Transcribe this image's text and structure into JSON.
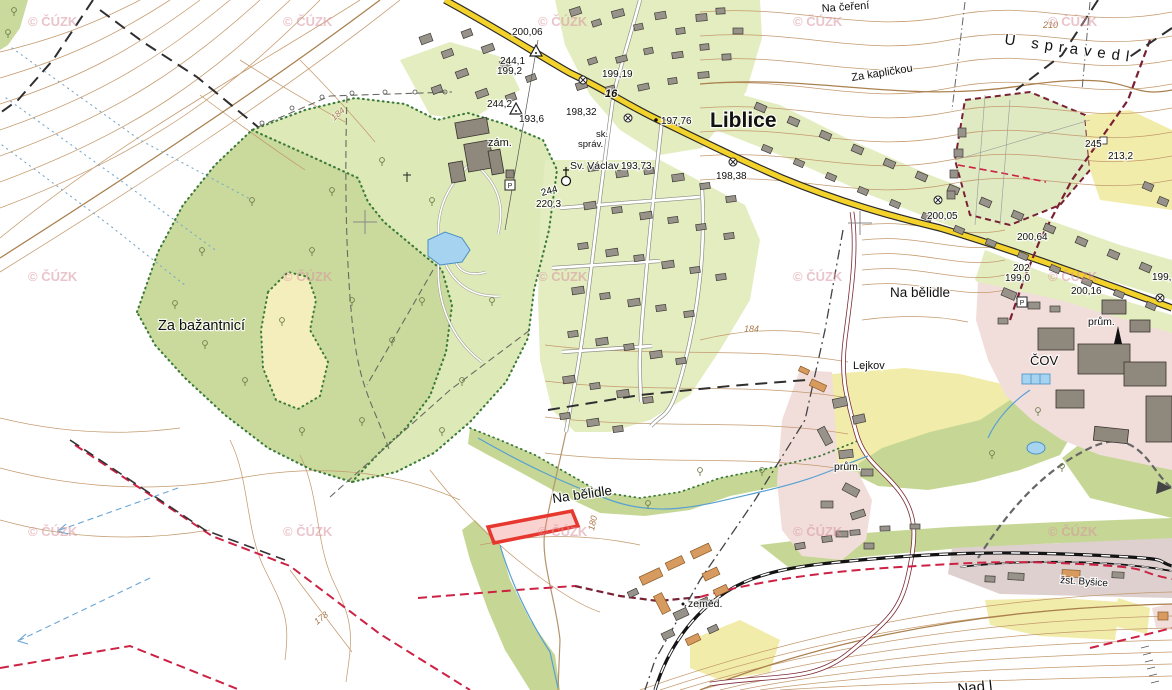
{
  "map": {
    "attribution": {
      "text": "© ČÚZK",
      "positions": [
        [
          28,
          26
        ],
        [
          283,
          26
        ],
        [
          538,
          26
        ],
        [
          793,
          26
        ],
        [
          1048,
          26
        ],
        [
          28,
          281
        ],
        [
          283,
          281
        ],
        [
          538,
          281
        ],
        [
          793,
          281
        ],
        [
          1048,
          281
        ],
        [
          28,
          536
        ],
        [
          283,
          536
        ],
        [
          538,
          536
        ],
        [
          793,
          536
        ],
        [
          1048,
          536
        ]
      ]
    },
    "labels": {
      "liblice": "Liblice",
      "za_bazantnici": "Za bažantnicí",
      "na_belidle_top": "Na bělidle",
      "na_belidle_bottom": "Na bělidle",
      "na_cereni": "Na čeření",
      "za_kaplickou": "Za kapličkou",
      "u_spravedl": "U spravedl",
      "lejkov": "Lejkov",
      "cov": "ČOV",
      "prum_right": "prům.",
      "prum_left": "prům.",
      "zemed": "zeměd.",
      "zst_bysice": "žst. Byšice",
      "zam": "zám.",
      "sk": "sk.",
      "sprav": "správ.",
      "sv_vaclav": "Sv. Václav",
      "nad_partial": "Nad l"
    },
    "road_number": "16",
    "elevations": {
      "e20006": "200,06",
      "e2441": "244,1",
      "e1992": "199,2",
      "e2442": "244,2",
      "e1936": "193,6",
      "e19919": "199,19",
      "e19832": "198,32",
      "e19776": "197,76",
      "e19373": "193,73",
      "e19838": "198,38",
      "e244": "244",
      "e2203": "220,3",
      "e20005": "200,05",
      "e20064": "200,64",
      "e202": "202",
      "e1990": "199,0",
      "e20016": "200,16",
      "e199": "199,",
      "e2132": "213,2",
      "e245": "245"
    },
    "contour_labels": {
      "c210": "210",
      "c184a": "184",
      "c184b": "184",
      "c180": "180",
      "c178": "178"
    },
    "symbols": {
      "parking": "P"
    },
    "colors": {
      "forest": "#c9da9c",
      "park": "#dde9b6",
      "village": "#e3edc0",
      "clearing": "#f4eebc",
      "industrial": "#f1dedb",
      "field_yellow": "#f2ecaa",
      "water": "#a6d3f0",
      "road_yellow": "#f3d32b",
      "contour": "#c49a6e",
      "boundary_red": "#cc2244",
      "cadastre_maroon": "#7a2035",
      "highlight_red": "#e6382f",
      "watermark_pink": "#d894a0",
      "building_gray": "#97938b",
      "building_orange": "#d79a5f"
    },
    "buildings": [
      [
        570,
        8,
        11,
        7,
        -18,
        "g"
      ],
      [
        592,
        20,
        9,
        6,
        -18,
        "g"
      ],
      [
        612,
        10,
        12,
        7,
        -15,
        "g"
      ],
      [
        634,
        24,
        9,
        6,
        -12,
        "g"
      ],
      [
        655,
        12,
        11,
        7,
        -10,
        "g"
      ],
      [
        676,
        28,
        9,
        6,
        -8,
        "g"
      ],
      [
        696,
        14,
        11,
        7,
        -5,
        "g"
      ],
      [
        700,
        44,
        9,
        6,
        -5,
        "g"
      ],
      [
        672,
        52,
        11,
        6,
        -8,
        "g"
      ],
      [
        644,
        48,
        9,
        6,
        -12,
        "g"
      ],
      [
        616,
        56,
        11,
        6,
        -15,
        "g"
      ],
      [
        588,
        58,
        9,
        6,
        -18,
        "g"
      ],
      [
        576,
        82,
        11,
        7,
        -18,
        "g"
      ],
      [
        606,
        86,
        9,
        6,
        -15,
        "g"
      ],
      [
        638,
        84,
        11,
        6,
        -12,
        "g"
      ],
      [
        668,
        78,
        9,
        6,
        -8,
        "g"
      ],
      [
        698,
        72,
        11,
        6,
        -5,
        "g"
      ],
      [
        722,
        54,
        9,
        6,
        -3,
        "g"
      ],
      [
        733,
        28,
        10,
        6,
        0,
        "g"
      ],
      [
        716,
        8,
        9,
        6,
        -3,
        "g"
      ],
      [
        420,
        35,
        12,
        8,
        -20,
        "g"
      ],
      [
        442,
        50,
        11,
        7,
        -20,
        "g"
      ],
      [
        462,
        30,
        10,
        7,
        -20,
        "g"
      ],
      [
        482,
        45,
        12,
        7,
        -20,
        "g"
      ],
      [
        500,
        60,
        10,
        7,
        -20,
        "g"
      ],
      [
        456,
        70,
        12,
        7,
        -20,
        "g"
      ],
      [
        432,
        86,
        10,
        7,
        -20,
        "g"
      ],
      [
        476,
        90,
        12,
        7,
        -20,
        "g"
      ],
      [
        506,
        94,
        10,
        7,
        -20,
        "g"
      ],
      [
        526,
        75,
        10,
        6,
        -20,
        "g"
      ],
      [
        755,
        104,
        11,
        7,
        23,
        "g"
      ],
      [
        788,
        118,
        11,
        7,
        23,
        "g"
      ],
      [
        820,
        132,
        11,
        7,
        23,
        "g"
      ],
      [
        852,
        146,
        11,
        7,
        23,
        "g"
      ],
      [
        884,
        160,
        11,
        7,
        23,
        "g"
      ],
      [
        916,
        173,
        11,
        7,
        23,
        "g"
      ],
      [
        948,
        186,
        11,
        7,
        23,
        "g"
      ],
      [
        980,
        199,
        11,
        7,
        23,
        "g"
      ],
      [
        1012,
        212,
        11,
        7,
        23,
        "g"
      ],
      [
        1044,
        225,
        11,
        7,
        23,
        "g"
      ],
      [
        1076,
        238,
        11,
        7,
        23,
        "g"
      ],
      [
        1108,
        251,
        11,
        7,
        23,
        "g"
      ],
      [
        1140,
        264,
        11,
        7,
        23,
        "g"
      ],
      [
        762,
        146,
        10,
        6,
        23,
        "g"
      ],
      [
        794,
        160,
        10,
        6,
        23,
        "g"
      ],
      [
        826,
        174,
        10,
        6,
        23,
        "g"
      ],
      [
        858,
        188,
        10,
        6,
        23,
        "g"
      ],
      [
        890,
        201,
        10,
        6,
        23,
        "g"
      ],
      [
        922,
        214,
        10,
        6,
        23,
        "g"
      ],
      [
        954,
        227,
        10,
        6,
        23,
        "g"
      ],
      [
        986,
        240,
        10,
        6,
        23,
        "g"
      ],
      [
        1018,
        253,
        10,
        6,
        23,
        "g"
      ],
      [
        1050,
        266,
        10,
        6,
        23,
        "g"
      ],
      [
        1082,
        279,
        10,
        6,
        23,
        "g"
      ],
      [
        1114,
        291,
        10,
        6,
        23,
        "g"
      ],
      [
        1146,
        303,
        10,
        6,
        23,
        "g"
      ],
      [
        588,
        165,
        10,
        6,
        -8,
        "g"
      ],
      [
        616,
        170,
        12,
        7,
        -8,
        "g"
      ],
      [
        644,
        168,
        10,
        6,
        -8,
        "g"
      ],
      [
        672,
        174,
        12,
        7,
        -8,
        "g"
      ],
      [
        700,
        183,
        10,
        6,
        -8,
        "g"
      ],
      [
        726,
        196,
        10,
        6,
        -8,
        "g"
      ],
      [
        584,
        202,
        12,
        7,
        -8,
        "g"
      ],
      [
        612,
        207,
        10,
        6,
        -8,
        "g"
      ],
      [
        640,
        212,
        12,
        7,
        -8,
        "g"
      ],
      [
        668,
        217,
        10,
        6,
        -8,
        "g"
      ],
      [
        696,
        224,
        10,
        6,
        -8,
        "g"
      ],
      [
        724,
        233,
        10,
        6,
        -8,
        "g"
      ],
      [
        578,
        243,
        10,
        6,
        -8,
        "g"
      ],
      [
        606,
        249,
        12,
        7,
        -8,
        "g"
      ],
      [
        634,
        255,
        10,
        6,
        -8,
        "g"
      ],
      [
        662,
        261,
        12,
        7,
        -8,
        "g"
      ],
      [
        690,
        267,
        10,
        6,
        -8,
        "g"
      ],
      [
        716,
        274,
        10,
        6,
        -8,
        "g"
      ],
      [
        572,
        287,
        12,
        7,
        -8,
        "g"
      ],
      [
        600,
        293,
        10,
        6,
        -8,
        "g"
      ],
      [
        628,
        299,
        12,
        7,
        -8,
        "g"
      ],
      [
        656,
        305,
        10,
        6,
        -8,
        "g"
      ],
      [
        684,
        311,
        10,
        6,
        -8,
        "g"
      ],
      [
        568,
        331,
        10,
        6,
        -8,
        "g"
      ],
      [
        596,
        338,
        12,
        7,
        -8,
        "g"
      ],
      [
        624,
        344,
        10,
        6,
        -8,
        "g"
      ],
      [
        650,
        351,
        12,
        7,
        -8,
        "g"
      ],
      [
        676,
        358,
        10,
        6,
        -8,
        "g"
      ],
      [
        563,
        376,
        12,
        7,
        -8,
        "g"
      ],
      [
        590,
        383,
        10,
        6,
        -8,
        "g"
      ],
      [
        617,
        390,
        12,
        7,
        -8,
        "g"
      ],
      [
        643,
        397,
        10,
        6,
        -8,
        "g"
      ],
      [
        560,
        413,
        10,
        6,
        -8,
        "g"
      ],
      [
        587,
        419,
        12,
        7,
        -8,
        "g"
      ],
      [
        613,
        426,
        10,
        6,
        -8,
        "g"
      ],
      [
        958,
        128,
        8,
        9,
        0,
        "g"
      ],
      [
        954,
        149,
        9,
        8,
        0,
        "g"
      ],
      [
        950,
        170,
        8,
        8,
        0,
        "g"
      ],
      [
        947,
        191,
        8,
        8,
        0,
        "g"
      ],
      [
        1143,
        183,
        10,
        7,
        23,
        "g"
      ],
      [
        1158,
        198,
        10,
        7,
        23,
        "g"
      ],
      [
        1038,
        328,
        36,
        22,
        0,
        "d"
      ],
      [
        1078,
        344,
        52,
        30,
        0,
        "d"
      ],
      [
        1102,
        300,
        24,
        14,
        0,
        "d"
      ],
      [
        1124,
        362,
        42,
        24,
        0,
        "d"
      ],
      [
        1056,
        390,
        28,
        18,
        0,
        "d"
      ],
      [
        1130,
        320,
        20,
        12,
        0,
        "d"
      ],
      [
        1146,
        396,
        26,
        46,
        0,
        "d"
      ],
      [
        1094,
        428,
        34,
        14,
        6,
        "d"
      ],
      [
        1002,
        290,
        14,
        8,
        23,
        "g"
      ],
      [
        1028,
        302,
        12,
        7,
        0,
        "g"
      ],
      [
        1050,
        306,
        10,
        6,
        0,
        "g"
      ],
      [
        998,
        318,
        10,
        6,
        0,
        "g"
      ],
      [
        799,
        368,
        10,
        5,
        25,
        "o"
      ],
      [
        810,
        382,
        16,
        7,
        25,
        "o"
      ],
      [
        833,
        398,
        14,
        9,
        -12,
        "g"
      ],
      [
        853,
        415,
        12,
        8,
        -12,
        "g"
      ],
      [
        816,
        432,
        18,
        8,
        62,
        "g"
      ],
      [
        839,
        450,
        14,
        8,
        -6,
        "g"
      ],
      [
        861,
        469,
        12,
        7,
        0,
        "g"
      ],
      [
        843,
        486,
        16,
        8,
        28,
        "g"
      ],
      [
        821,
        501,
        12,
        7,
        0,
        "g"
      ],
      [
        851,
        511,
        14,
        7,
        -18,
        "g"
      ],
      [
        836,
        531,
        12,
        6,
        0,
        "g"
      ],
      [
        864,
        543,
        10,
        6,
        0,
        "g"
      ],
      [
        640,
        572,
        22,
        9,
        -25,
        "o"
      ],
      [
        666,
        559,
        18,
        8,
        -25,
        "o"
      ],
      [
        691,
        547,
        20,
        8,
        -25,
        "o"
      ],
      [
        703,
        570,
        16,
        8,
        -25,
        "o"
      ],
      [
        652,
        599,
        20,
        9,
        63,
        "o"
      ],
      [
        674,
        610,
        14,
        8,
        -25,
        "g"
      ],
      [
        697,
        599,
        12,
        7,
        -25,
        "g"
      ],
      [
        714,
        587,
        14,
        7,
        -25,
        "o"
      ],
      [
        662,
        631,
        12,
        7,
        -25,
        "g"
      ],
      [
        686,
        636,
        14,
        7,
        -25,
        "o"
      ],
      [
        708,
        626,
        10,
        6,
        -25,
        "g"
      ],
      [
        628,
        590,
        10,
        6,
        -25,
        "g"
      ],
      [
        1008,
        573,
        16,
        7,
        3,
        "g"
      ],
      [
        1062,
        570,
        18,
        7,
        3,
        "o"
      ],
      [
        1112,
        572,
        12,
        6,
        3,
        "g"
      ],
      [
        985,
        576,
        10,
        6,
        3,
        "g"
      ],
      [
        795,
        543,
        10,
        6,
        -10,
        "g"
      ],
      [
        822,
        536,
        10,
        6,
        -8,
        "g"
      ],
      [
        850,
        530,
        10,
        5,
        -4,
        "g"
      ],
      [
        880,
        526,
        10,
        5,
        -2,
        "g"
      ],
      [
        910,
        524,
        10,
        5,
        0,
        "g"
      ],
      [
        1158,
        612,
        10,
        8,
        0,
        "o"
      ],
      [
        456,
        120,
        32,
        16,
        -10,
        "d"
      ],
      [
        466,
        142,
        26,
        28,
        -10,
        "d"
      ],
      [
        450,
        162,
        14,
        20,
        -10,
        "d"
      ],
      [
        490,
        150,
        12,
        24,
        -10,
        "d"
      ],
      [
        506,
        170,
        8,
        8,
        0,
        "d"
      ]
    ],
    "trees": [
      [
        175,
        305
      ],
      [
        205,
        345
      ],
      [
        245,
        382
      ],
      [
        282,
        322
      ],
      [
        312,
        252
      ],
      [
        352,
        302
      ],
      [
        392,
        342
      ],
      [
        422,
        302
      ],
      [
        362,
        422
      ],
      [
        302,
        432
      ],
      [
        432,
        202
      ],
      [
        382,
        162
      ],
      [
        332,
        192
      ],
      [
        462,
        382
      ],
      [
        492,
        302
      ],
      [
        202,
        252
      ],
      [
        252,
        202
      ],
      [
        442,
        432
      ],
      [
        1038,
        412
      ],
      [
        1062,
        468
      ],
      [
        762,
        472
      ],
      [
        992,
        455
      ],
      [
        700,
        472
      ],
      [
        648,
        505
      ],
      [
        14,
        12
      ],
      [
        8,
        34
      ]
    ]
  }
}
